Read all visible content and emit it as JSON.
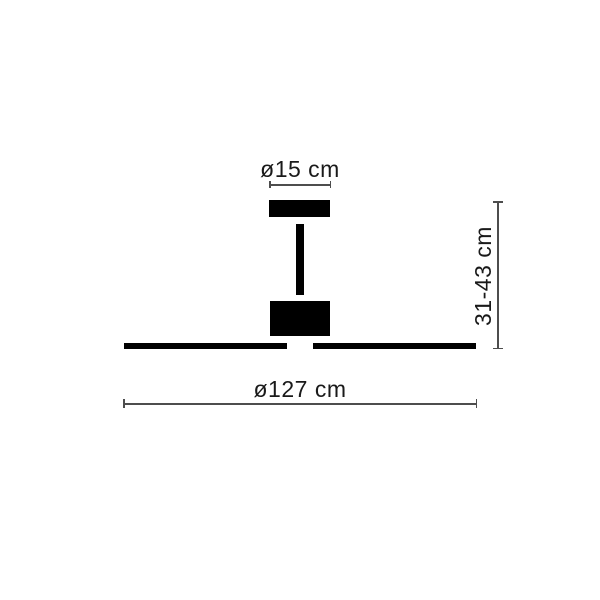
{
  "diagram": {
    "labels": {
      "canopy_diameter": "ø15 cm",
      "height_range": "31-43 cm",
      "blade_diameter": "ø127 cm"
    },
    "colors": {
      "background": "#ffffff",
      "fan_fill": "#000000",
      "dim_line": "#4d4d4d",
      "label_text": "#1a1a1a"
    }
  }
}
